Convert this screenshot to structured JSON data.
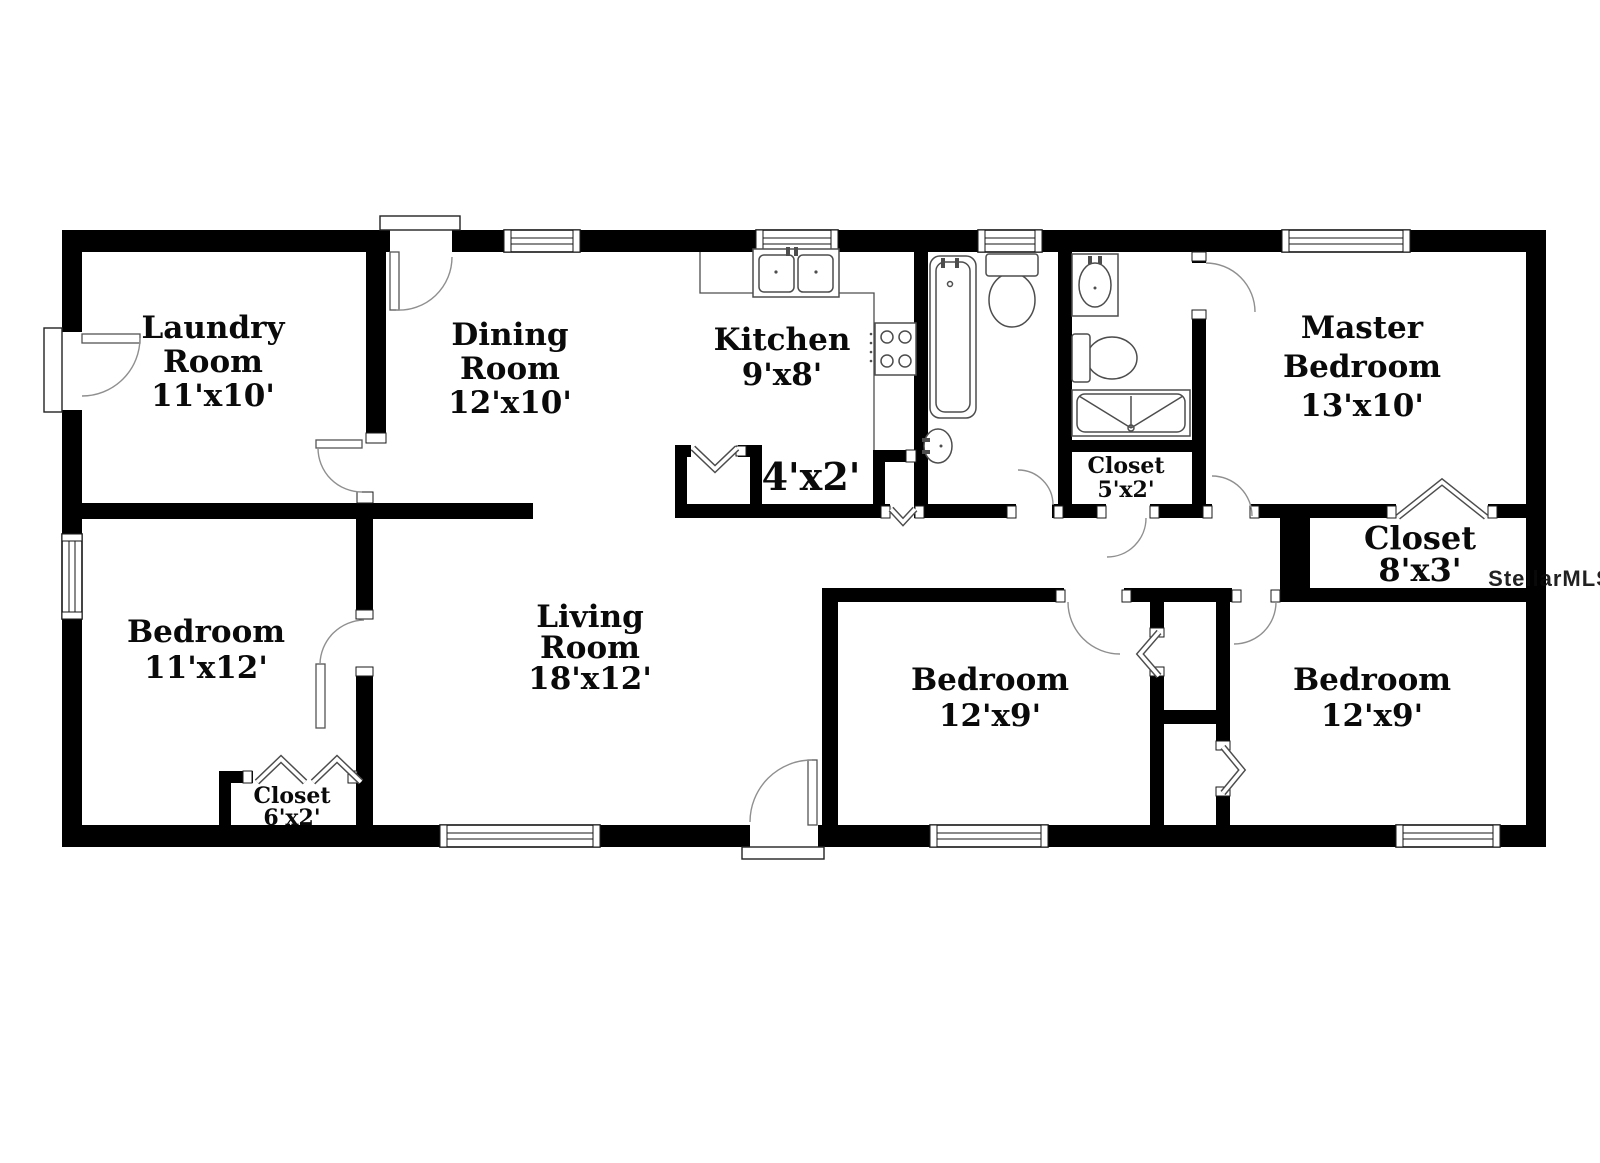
{
  "watermark": "StellarMLS",
  "colors": {
    "wall": "#000000",
    "floor": "#ffffff",
    "fixture_line": "#4d4d4d",
    "door_line": "#8f8f8f",
    "watermark": "#d4d4d4"
  },
  "rooms": {
    "laundry": {
      "name_line1": "Laundry",
      "name_line2": "Room",
      "dims": "11'x10'"
    },
    "dining": {
      "name_line1": "Dining",
      "name_line2": "Room",
      "dims": "12'x10'"
    },
    "kitchen": {
      "name_line1": "Kitchen",
      "dims": "9'x8'"
    },
    "master_bedroom": {
      "name_line1": "Master",
      "name_line2": "Bedroom",
      "dims": "13'x10'"
    },
    "living_room": {
      "name_line1": "Living",
      "name_line2": "Room",
      "dims": "18'x12'"
    },
    "bedroom_left": {
      "name_line1": "Bedroom",
      "dims": "11'x12'"
    },
    "bedroom_middle": {
      "name_line1": "Bedroom",
      "dims": "12'x9'"
    },
    "bedroom_right": {
      "name_line1": "Bedroom",
      "dims": "12'x9'"
    },
    "closet_hall_bath": {
      "name_line1": "Closet",
      "dims": "5'x2'"
    },
    "closet_kitchen": {
      "dims": "4'x2'"
    },
    "closet_master": {
      "name_line1": "Closet",
      "dims": "8'x3'"
    },
    "closet_bedroom_left": {
      "name_line1": "Closet",
      "dims": "6'x2'"
    }
  }
}
